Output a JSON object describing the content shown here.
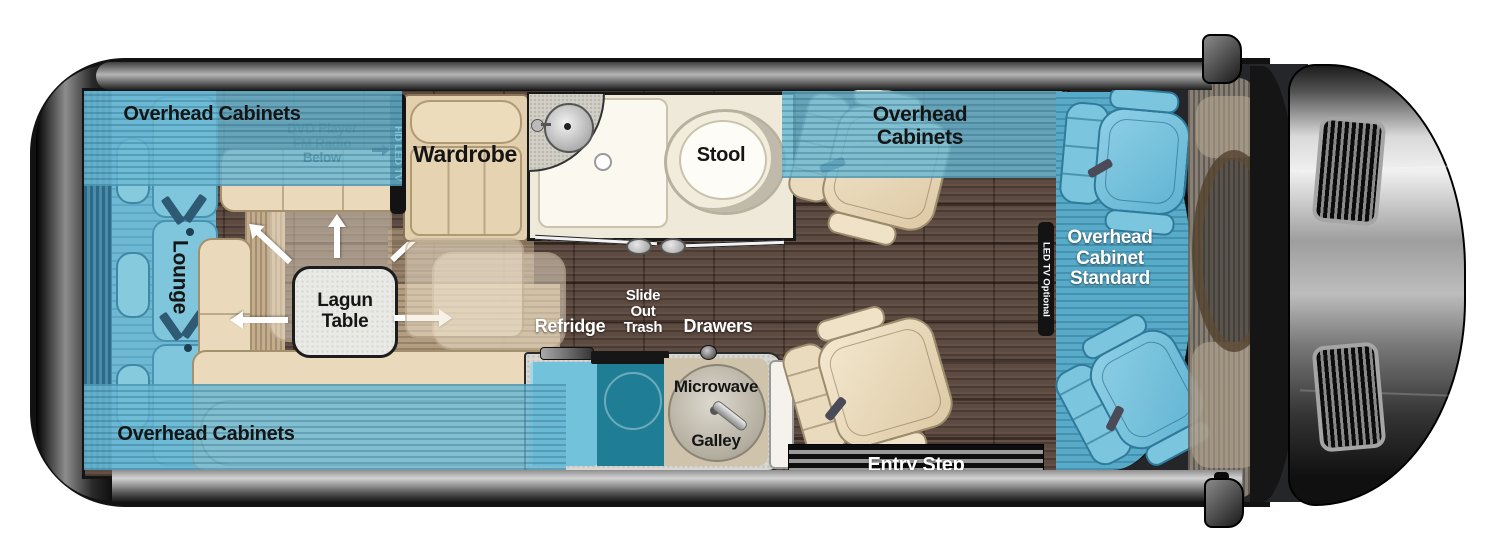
{
  "title": "Class B motorhome floorplan (top view)",
  "labels": {
    "overhead_cabinets_rear_top": "Overhead Cabinets",
    "overhead_cabinets_rear_bottom": "Overhead Cabinets",
    "overhead_cabinets_mid": "Overhead\nCabinets",
    "overhead_cabinet_standard": "Overhead\nCabinet\nStandard",
    "dvd_fm": "DVD Player\nFM Radio\nBelow",
    "hd_led_tv": "HD LED TV",
    "led_tv_optional": "LED TV Optional",
    "lounge": "Lounge",
    "lagun_table": "Lagun\nTable",
    "wardrobe": "Wardrobe",
    "stool": "Stool",
    "refridge": "Refridge",
    "slide_out_trash": "Slide\nOut\nTrash",
    "drawers": "Drawers",
    "microwave": "Microwave",
    "galley": "Galley",
    "entry_step": "Entry Step"
  },
  "colors": {
    "highlight_blue": "#6ebcd8",
    "deep_teal": "#1f7e96",
    "upholstery_beige": "#e9d9ba",
    "wood_floor": "#5d4a41",
    "body_dark": "#141414",
    "label_white": "#ffffff",
    "label_black": "#151515"
  }
}
